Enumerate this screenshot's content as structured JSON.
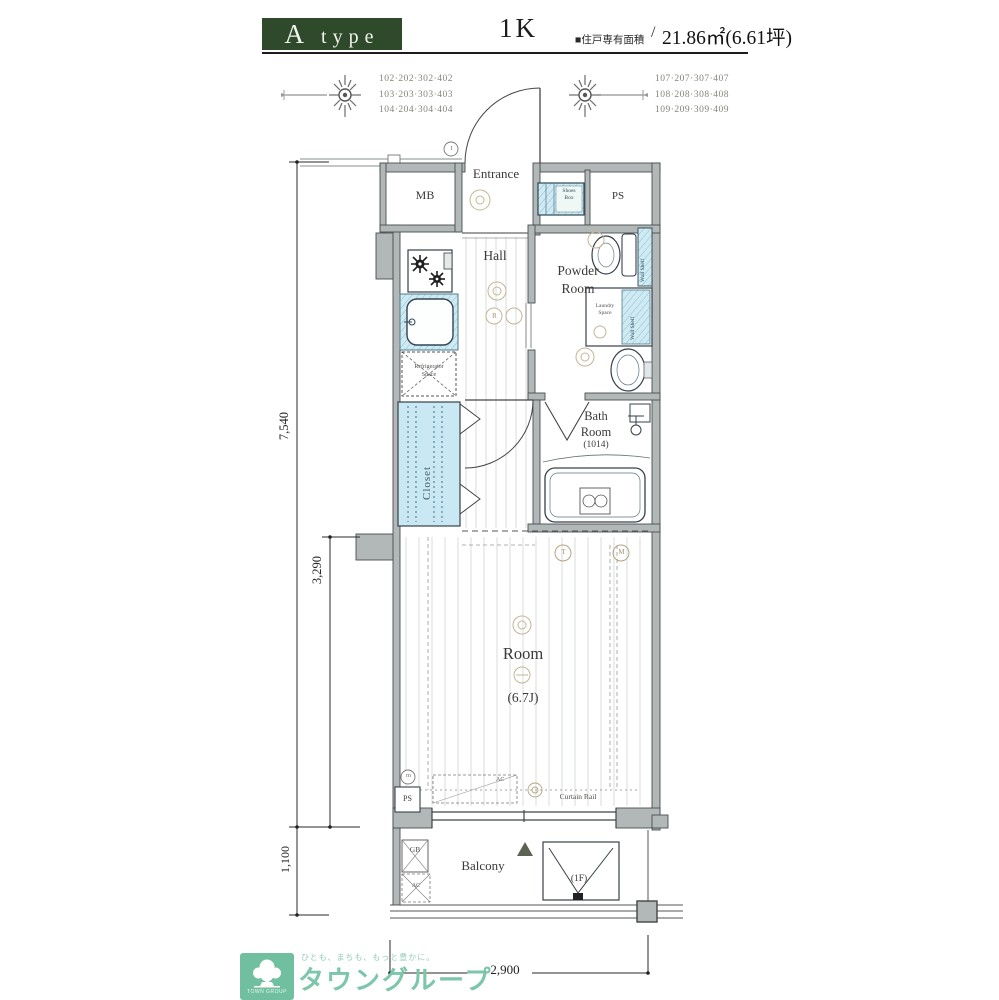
{
  "header": {
    "type_label": "A type",
    "plan_type": "1K",
    "area_label": "■住戸専有面積",
    "area_slash": "/",
    "area_value": "21.86㎡(6.61坪)"
  },
  "compass": {
    "left_units": [
      "102·202·302·402",
      "103·203·303·403",
      "104·204·304·404"
    ],
    "right_units": [
      "107·207·307·407",
      "108·208·308·408",
      "109·209·309·409"
    ]
  },
  "plan": {
    "mb": "MB",
    "entrance": "Entrance",
    "shoes_box": "Shoes\nBox",
    "ps": "PS",
    "hall": "Hall",
    "powder_room": "Powder\nRoom",
    "wall_shelf": "Wall Shelf",
    "laundry_space": "Laundry\nSpace",
    "bath_room": "Bath\nRoom",
    "bath_size": "(1014)",
    "closet": "Closet",
    "refrigerator": "Refrigerator\nSpace",
    "room": "Room",
    "room_size": "(6.7J)",
    "curtain_rail": "Curtain Rail",
    "room_ac": "AC",
    "ps_small": "PS",
    "meter": "m",
    "outlet_t": "T",
    "outlet_m": "M",
    "outlet_r": "R",
    "entry_t": "t",
    "balcony": "Balcony",
    "gb": "GB",
    "balcony_ac": "AC",
    "hatch_floor": "(1F)"
  },
  "dimensions": {
    "total_depth": "7,540",
    "room_depth": "3,290",
    "balcony_depth": "1,100",
    "width": "2,900"
  },
  "footer": {
    "tagline": "ひとも、まちも、もっと豊かに。",
    "brand": "タウングループ",
    "logo_text": "TOWN GROUP"
  },
  "colors": {
    "accent_green": "#2e4a2b",
    "brand_green": "#6fbfa0",
    "aqua": "#cfeaf3",
    "wall_gray": "#b2b7b7"
  }
}
